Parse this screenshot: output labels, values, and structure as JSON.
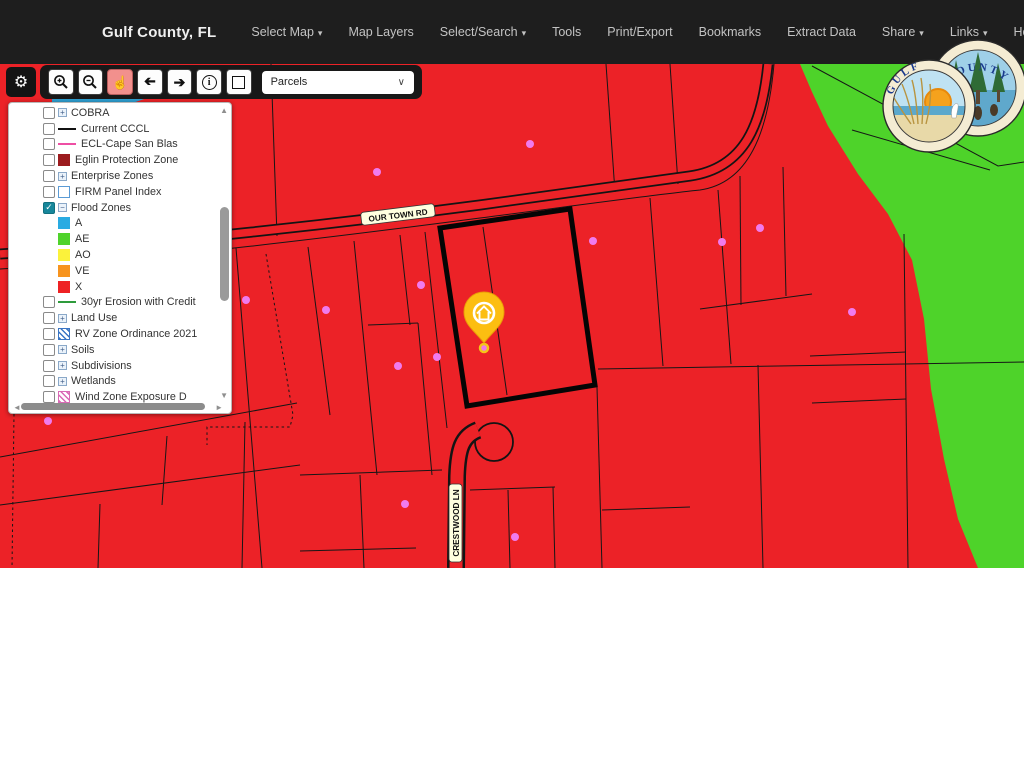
{
  "header": {
    "title": "Gulf County, FL",
    "menu": [
      {
        "label": "Select Map",
        "caret": "▾"
      },
      {
        "label": "Map Layers",
        "caret": ""
      },
      {
        "label": "Select/Search",
        "caret": "▾"
      },
      {
        "label": "Tools",
        "caret": ""
      },
      {
        "label": "Print/Export",
        "caret": ""
      },
      {
        "label": "Bookmarks",
        "caret": ""
      },
      {
        "label": "Extract Data",
        "caret": ""
      },
      {
        "label": "Share",
        "caret": "▾"
      },
      {
        "label": "Links",
        "caret": "▾"
      },
      {
        "label": "Help",
        "caret": ""
      }
    ]
  },
  "toolbar": {
    "dropdown_value": "Parcels",
    "icons": [
      "settings-gear",
      "zoom-in",
      "zoom-out",
      "pan-hand",
      "previous-extent",
      "next-extent",
      "identify-info",
      "box-select"
    ],
    "active_tool": "pan-hand"
  },
  "layers_panel": {
    "items": [
      {
        "label": "COBRA",
        "checkbox": true,
        "checked": false,
        "expander": "+"
      },
      {
        "label": "Current CCCL",
        "checkbox": true,
        "checked": false,
        "swatch": {
          "kind": "line",
          "color": "#111111"
        }
      },
      {
        "label": "ECL-Cape San Blas",
        "checkbox": true,
        "checked": false,
        "swatch": {
          "kind": "line",
          "color": "#EE4FA4"
        }
      },
      {
        "label": "Eglin Protection Zone",
        "checkbox": true,
        "checked": false,
        "swatch": {
          "kind": "fill",
          "color": "#9B1B1E"
        }
      },
      {
        "label": "Enterprise Zones",
        "checkbox": true,
        "checked": false,
        "expander": "+"
      },
      {
        "label": "FIRM Panel Index",
        "checkbox": true,
        "checked": false,
        "swatch": {
          "kind": "box",
          "color": "#5B9BD5"
        }
      },
      {
        "label": "Flood Zones",
        "checkbox": true,
        "checked": true,
        "expander": "−"
      },
      {
        "label": "A",
        "indent": true,
        "swatch": {
          "kind": "fill",
          "color": "#29ABE2"
        }
      },
      {
        "label": "AE",
        "indent": true,
        "swatch": {
          "kind": "fill",
          "color": "#4FD32B"
        }
      },
      {
        "label": "AO",
        "indent": true,
        "swatch": {
          "kind": "fill",
          "color": "#FBF23B"
        }
      },
      {
        "label": "VE",
        "indent": true,
        "swatch": {
          "kind": "fill",
          "color": "#F7941E"
        }
      },
      {
        "label": "X",
        "indent": true,
        "swatch": {
          "kind": "fill",
          "color": "#EE2224"
        }
      },
      {
        "label": "30yr Erosion with Credit",
        "checkbox": true,
        "checked": false,
        "swatch": {
          "kind": "line",
          "color": "#2E9B3C"
        }
      },
      {
        "label": "Land Use",
        "checkbox": true,
        "checked": false,
        "expander": "+"
      },
      {
        "label": "RV Zone Ordinance 2021",
        "checkbox": true,
        "checked": false,
        "swatch": {
          "kind": "hatch",
          "color": "#3A75C4"
        }
      },
      {
        "label": "Soils",
        "checkbox": true,
        "checked": false,
        "expander": "+"
      },
      {
        "label": "Subdivisions",
        "checkbox": true,
        "checked": false,
        "expander": "+"
      },
      {
        "label": "Wetlands",
        "checkbox": true,
        "checked": false,
        "expander": "+"
      },
      {
        "label": "Wind Zone Exposure D",
        "checkbox": true,
        "checked": false,
        "swatch": {
          "kind": "hatch",
          "color": "#D96AB5"
        }
      }
    ]
  },
  "map": {
    "road_labels": {
      "primary": "OUR TOWN RD",
      "secondary": "CRESTWOOD LN"
    },
    "marker": "house-location-pin",
    "colors": {
      "flood_x_red": "#EC2227",
      "flood_ae_green": "#4ED32A",
      "flood_a_blue": "#2D9FD1",
      "address_point_pink": "#F07BEE",
      "marker_gold": "#FCBE11",
      "selected_parcel_outline": "#000000"
    }
  },
  "logo": {
    "left_circle_text": "GULF",
    "right_circle_text": "COUNTY"
  }
}
